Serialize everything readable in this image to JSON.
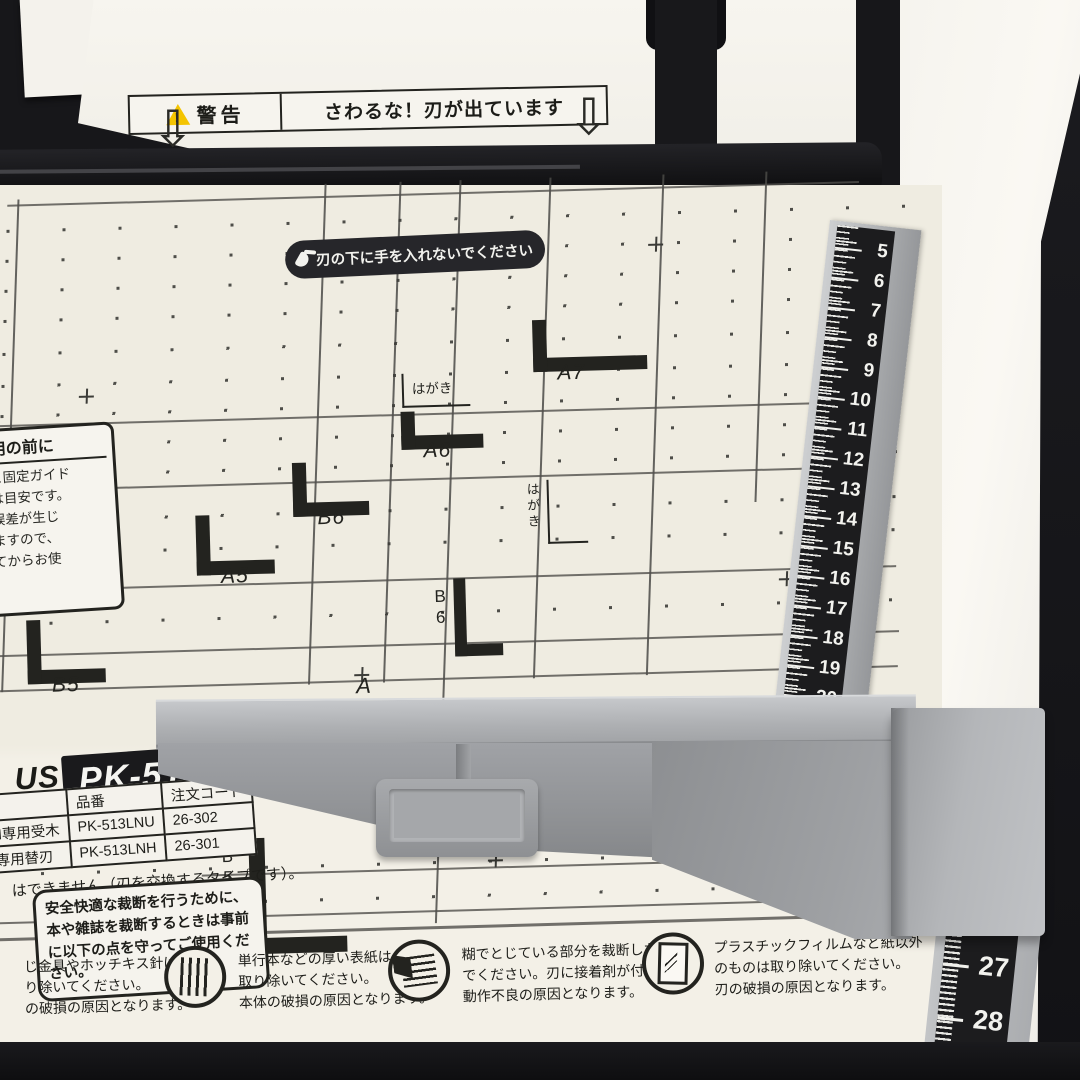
{
  "warning_label": {
    "badge": "警告",
    "text": "さわるな！刃が出ています"
  },
  "blade_caution": "刃の下に手を入れないでください",
  "before_use": {
    "title": "使用の前に",
    "body": "線と固定ガイド\n示は目安です。\n法誤差が生じ\nりますので、\nしてからお使"
  },
  "size_marks": {
    "a7": "A7",
    "a6": "A6",
    "b6": "B6",
    "a5": "A5",
    "b5": "B5",
    "b6_vertical": "B6",
    "b5_vertical": "B5",
    "hagaki_1": "はがき",
    "hagaki_2": "はがき",
    "partial_a": "A"
  },
  "brand": {
    "fragment": "US",
    "model": "PK-513"
  },
  "parts_table": {
    "col_part": "品番",
    "col_code": "注文コード",
    "rows": [
      {
        "name": "LN専用受木",
        "part": "PK-513LNU",
        "code": "26-302"
      },
      {
        "name": "N専用替刃",
        "part": "PK-513LNH",
        "code": "26-301"
      }
    ],
    "note": "はできません（刃を交換するタイプです）。"
  },
  "safety_note": "安全快適な裁断を行うために、本や雑誌を裁断するときは事前に以下の点を守ってご使用ください。",
  "cautions": [
    {
      "icon": null,
      "text": "じ金具やホッチキス針は\nり除いてください。\nの破損の原因となります。"
    },
    {
      "icon": "spiral-binding",
      "text": "単行本などの厚い表紙は\n取り除いてください。\n本体の破損の原因となります。"
    },
    {
      "icon": "glue-binding",
      "text": "糊でとじている部分を裁断しない\nでください。刃に接着剤が付着し、\n動作不良の原因となります。"
    },
    {
      "icon": "plastic-film",
      "text": "プラスチックフィルムなど紙以外\nのものは取り除いてください。\n刃の破損の原因となります。"
    }
  ],
  "ruler": {
    "main_numbers": [
      5,
      6,
      7,
      8,
      9,
      10,
      11,
      12,
      13,
      14,
      15,
      16,
      17,
      18,
      19,
      20
    ],
    "bottom_numbers": [
      26,
      27,
      28
    ]
  },
  "icons": {
    "down_arrow": "⇩",
    "exclaim": "!"
  },
  "colors": {
    "board": "#efece1",
    "fence_gray": "#97999d",
    "ruler_black": "#1c1c1e",
    "warning_yellow": "#f4c400",
    "background": "#141417"
  }
}
